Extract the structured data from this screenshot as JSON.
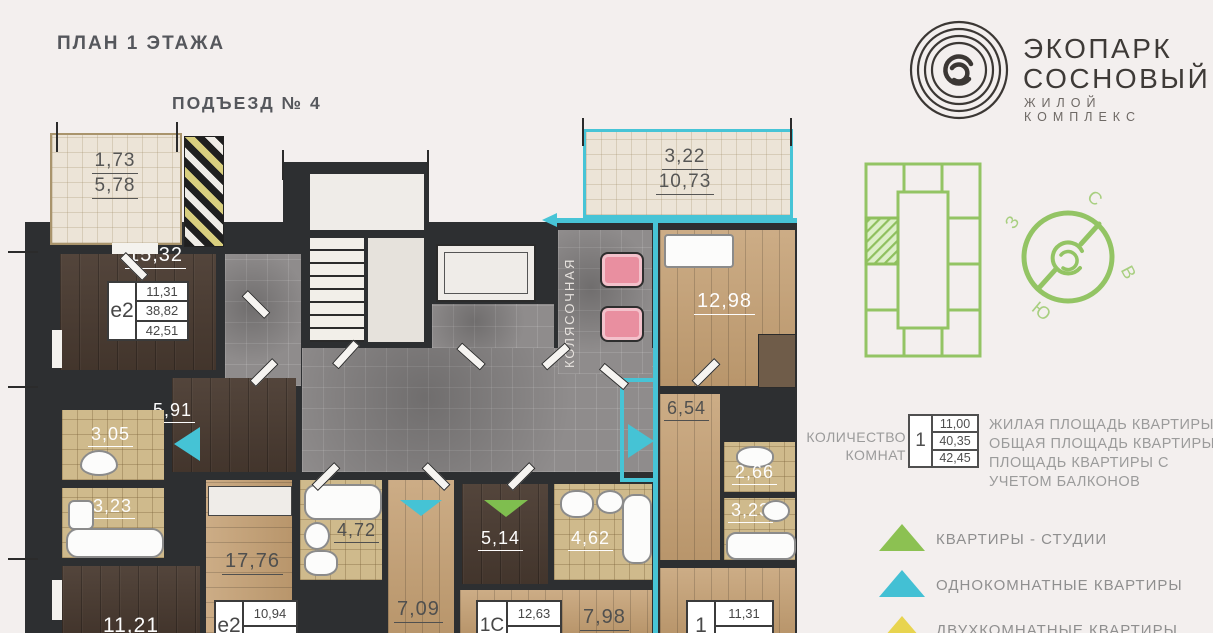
{
  "header": {
    "title": "ПЛАН 1 ЭТАЖА",
    "entrance": "ПОДЪЕЗД № 4"
  },
  "logo": {
    "line1": "ЭКОПАРК",
    "line2": "СОСНОВЫЙ",
    "tagline": "ЖИЛОЙ КОМПЛЕКС"
  },
  "plan": {
    "stroller_room": "КОЛЯСОЧНАЯ",
    "labels": {
      "balcony_left_top": "1,73",
      "balcony_left_bottom": "5,78",
      "balcony_right_top": "3,22",
      "balcony_right_bottom": "10,73",
      "room_1532": "15,32",
      "hall_591": "5,91",
      "wc_305": "3,05",
      "bath_323a": "3,23",
      "room_1121": "11,21",
      "kitchen_1776": "17,76",
      "bath_472": "4,72",
      "hall_709": "7,09",
      "room_514": "5,14",
      "bath_462": "4,62",
      "room_798": "7,98",
      "room_1298": "12,98",
      "hall_654": "6,54",
      "wc_266": "2,66",
      "bath_323b": "3,23"
    },
    "cards": {
      "e2_left": {
        "type": "е2",
        "rows": [
          "11,31",
          "38,82",
          "42,51"
        ]
      },
      "e2_bottom": {
        "type": "е2",
        "rows": [
          "10,94",
          "40,51"
        ]
      },
      "s1": {
        "type": "1С",
        "rows": [
          "12,63",
          "30,37"
        ]
      },
      "one": {
        "type": "1",
        "rows": [
          "11,31",
          "36,72"
        ]
      }
    }
  },
  "compass": {
    "n": "С",
    "e": "В",
    "s": "Ю",
    "w": "З"
  },
  "legend": {
    "rooms_count_label": "КОЛИЧЕСТВО КОМНАТ",
    "sample": {
      "type": "1",
      "rows": [
        "11,00",
        "40,35",
        "42,45"
      ]
    },
    "area_labels": {
      "living": "ЖИЛАЯ ПЛОЩАДЬ КВАРТИРЫ",
      "total": "ОБЩАЯ ПЛОЩАДЬ КВАРТИРЫ",
      "with_balcony": "ПЛОЩАДЬ КВАРТИРЫ С УЧЕТОМ БАЛКОНОВ"
    },
    "types": {
      "studio": {
        "label": "КВАРТИРЫ - СТУДИИ",
        "color": "#8cc152"
      },
      "one_room": {
        "label": "ОДНОКОМНАТНЫЕ КВАРТИРЫ",
        "color": "#43c0d4"
      },
      "two_room": {
        "label": "ДВУХКОМНАТНЫЕ КВАРТИРЫ",
        "color": "#e8d44f"
      }
    }
  },
  "colors": {
    "accent_cyan": "#47c4d6",
    "map_green": "#93c464",
    "wall": "#2d2f31"
  }
}
